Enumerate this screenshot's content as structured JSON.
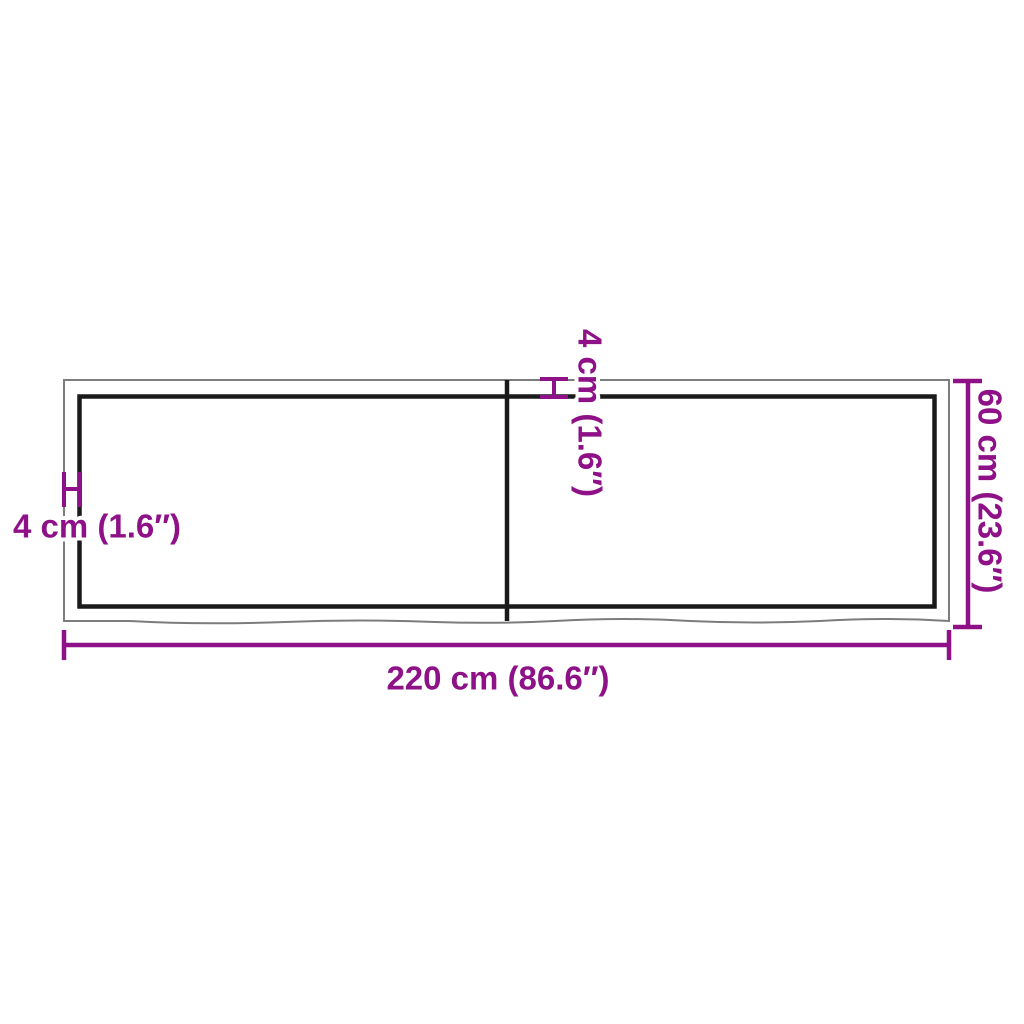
{
  "diagram": {
    "type": "product-dimension-diagram",
    "dimensions": {
      "width": {
        "cm": 220,
        "inches": 86.6,
        "label": "220 cm (86.6″)"
      },
      "depth": {
        "cm": 60,
        "inches": 23.6,
        "label": "60 cm (23.6″)"
      },
      "thickness": {
        "cm": 4,
        "inches": 1.6,
        "label": "4 cm (1.6″)"
      }
    },
    "labels": {
      "width": "220 cm (86.6″)",
      "depth": "60 cm (23.6″)",
      "thickness_left": "4 cm (1.6″)",
      "thickness_center": "4 cm (1.6″)"
    },
    "colors": {
      "accent": "#8E1188",
      "inner_outline": "#1A1A1A",
      "outer_edge": "#7C7C7C",
      "background": "#FFFFFF"
    }
  }
}
